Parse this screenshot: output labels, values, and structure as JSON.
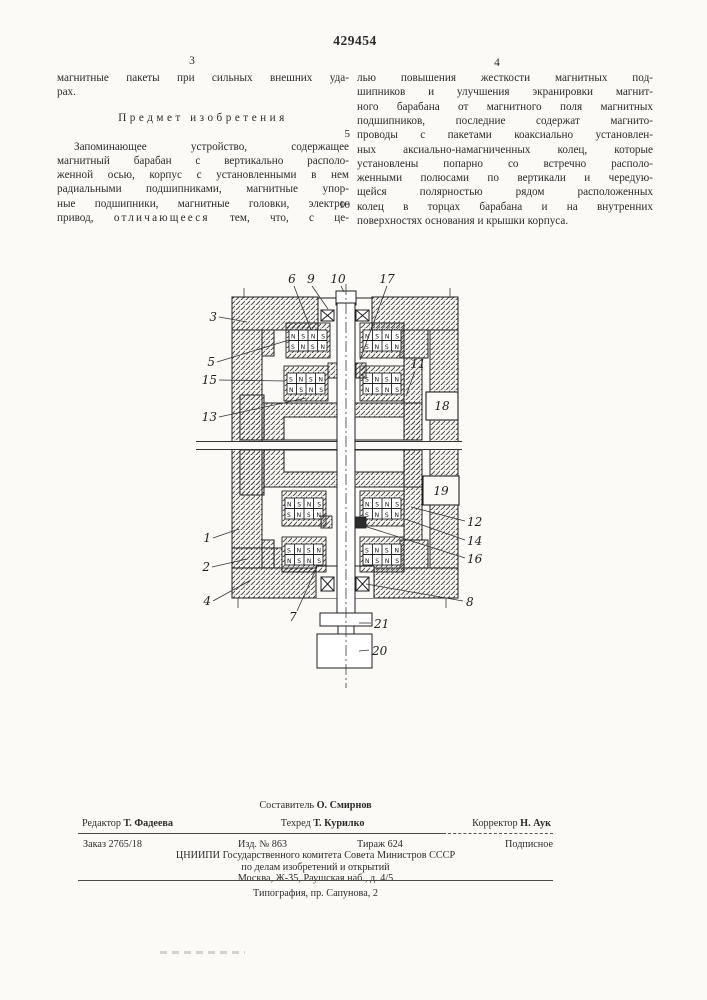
{
  "page": {
    "patent_number": "429454",
    "page_number_left": "3",
    "page_number_right": "4",
    "margin_line_numbers": [
      "5",
      "10"
    ]
  },
  "left_column": {
    "intro_lines": [
      "магнитные пакеты при сильных внешних уда-",
      "рах."
    ],
    "heading": "Предмет изобретения",
    "claim_lines": [
      "Запоминающее устройство, содержащее",
      "магнитный барабан с вертикально располо-",
      "женной осью, корпус с установленными в нем",
      "радиальными подшипниками, магнитные упор-",
      "ные подшипники, магнитные головки, электро-"
    ],
    "last_line": {
      "pre": "привод, ",
      "emphasized": "отличающееся",
      "post": " тем, что, с це-"
    }
  },
  "right_column": {
    "claim_lines": [
      "лью повышения жесткости магнитных под-",
      "шипников и улучшения экранировки магнит-",
      "ного барабана от магнитного поля магнитных",
      "подшипников, последние содержат магнито-",
      "проводы с пакетами коаксиально установлен-",
      "ных аксиально-намагниченных колец, которые",
      "установлены попарно со встречно располо-",
      "женными полюсами по вертикали и чередую-",
      "щейся полярностью рядом расположенных",
      "колец в торцах барабана и на внутренних",
      "поверхностях основания и крышки корпуса."
    ]
  },
  "figure": {
    "labels": [
      "3",
      "5",
      "15",
      "13",
      "1",
      "2",
      "4",
      "6",
      "9",
      "10",
      "17",
      "11",
      "12",
      "14",
      "16",
      "8",
      "7",
      "21",
      "20",
      "18",
      "19"
    ],
    "magnet_row_top": "N S N S",
    "magnet_row_bottom": "S N S N"
  },
  "footer": {
    "compiler_label": "Составитель",
    "compiler_name": "О. Смирнов",
    "editor_label": "Редактор",
    "editor_name": "Т. Фадеева",
    "techred_label": "Техред",
    "techred_name": "Т. Курилко",
    "corrector_label": "Корректор",
    "corrector_name": "Н. Аук",
    "order": "Заказ 2765/18",
    "edition": "Изд. № 863",
    "circulation": "Тираж 624",
    "subscription": "Подписное",
    "org_line1": "ЦНИИПИ Государственного комитета Совета Министров СССР",
    "org_line2": "по делам изобретений и открытий",
    "org_line3": "Москва, Ж-35, Раушская наб., д. 4/5",
    "printer": "Типография, пр. Сапунова, 2"
  }
}
